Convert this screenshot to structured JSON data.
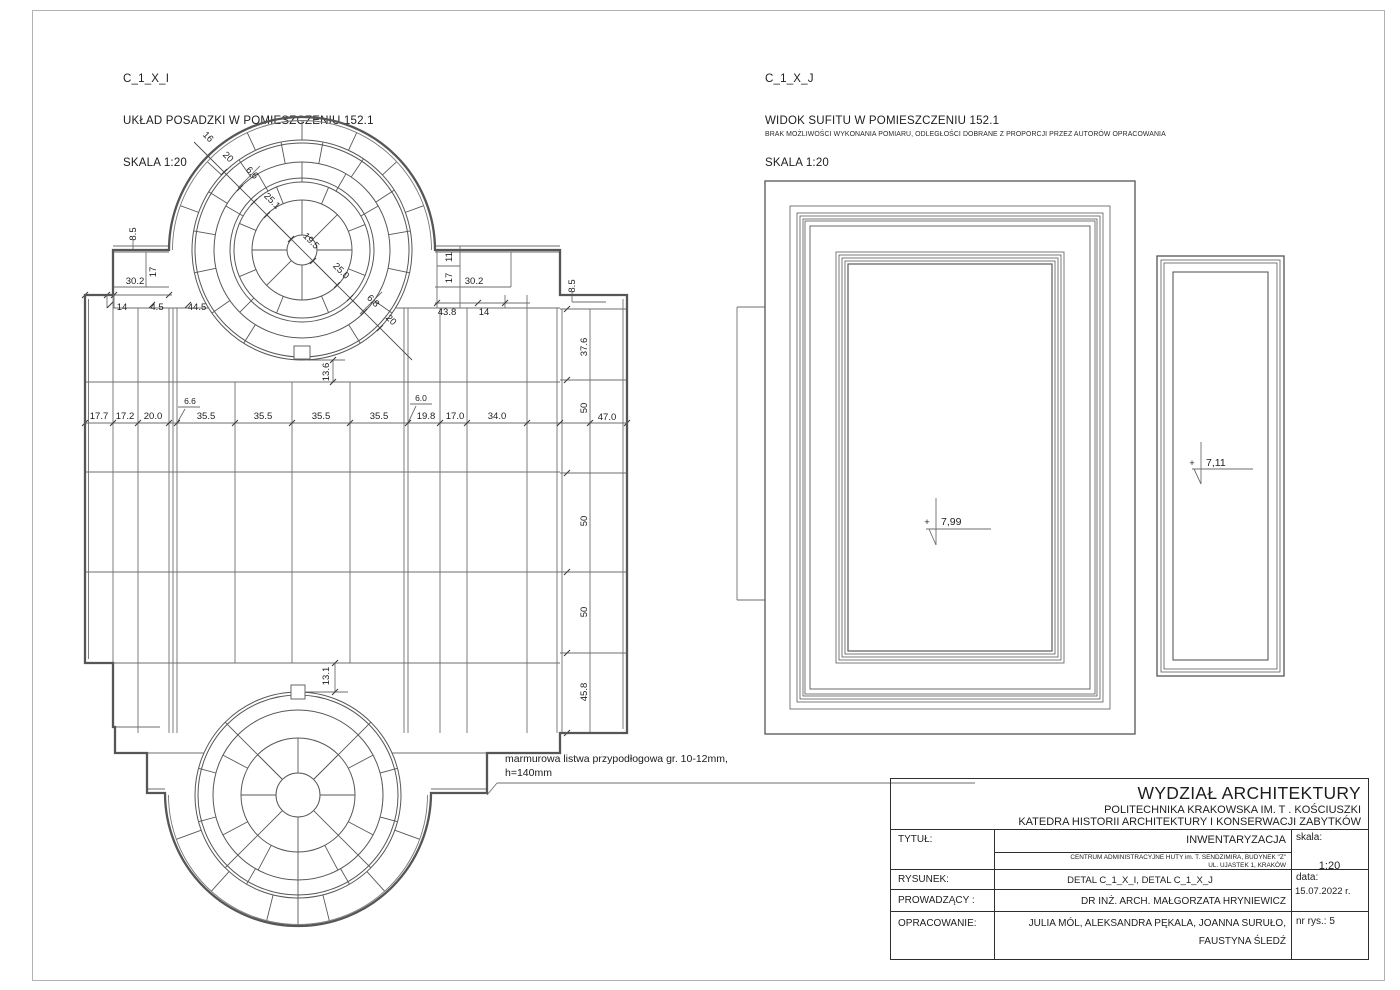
{
  "floor": {
    "heading": {
      "code": "C_1_X_I",
      "title": "UKŁAD POSADZKI W POMIESZCZENIU 152.1",
      "scale": "SKALA 1:20"
    },
    "apse_diag": [
      "16",
      "20",
      "6.6",
      "25.1",
      "19.5",
      "25.0",
      "6.8",
      "20"
    ],
    "top_left": {
      "h85": "8.5",
      "w302": "30.2",
      "w17": "17",
      "b14": "14",
      "b45": "4.5",
      "b445": "44.5"
    },
    "top_right": {
      "w11": "11",
      "w17": "17",
      "w302": "30.2",
      "b438": "43.8",
      "b14": "14",
      "h85": "8.5"
    },
    "columns": [
      "17.7",
      "17.2",
      "20.0",
      "6.6",
      "35.5",
      "35.5",
      "35.5",
      "35.5",
      "6.0",
      "19.8",
      "17.0",
      "34.0",
      "47.0"
    ],
    "rows": [
      "37.6",
      "50",
      "50",
      "50",
      "45.8"
    ],
    "gap_top": "13.6",
    "gap_bottom": "13.1",
    "note1": "marmurowa listwa przypodłogowa gr. 10-12mm,",
    "note2": "h=140mm"
  },
  "ceiling": {
    "heading": {
      "code": "C_1_X_J",
      "title": "WIDOK SUFITU W POMIESZCZENIU 152.1",
      "scale": "SKALA 1:20"
    },
    "note": "BRAK MOŻLIWOŚCI WYKONANIA POMIARU, ODLEGŁOŚCI DOBRANE Z PROPORCJI PRZEZ AUTORÓW OPRACOWANIA",
    "plus": "+",
    "level_main": "7,99",
    "level_side": "7,11"
  },
  "title_block": {
    "faculty": "WYDZIAŁ ARCHITEKTURY",
    "university": "POLITECHNIKA KRAKOWSKA IM. T . KOŚCIUSZKI",
    "department": "KATEDRA HISTORII ARCHITEKTURY I KONSERWACJI ZABYTKÓW",
    "title_label": "TYTUŁ:",
    "title_value": "INWENTARYZACJA",
    "address1": "CENTRUM ADMINISTRACYJNE HUTY im. T. SENDZIMIRA, BUDYNEK \"Z\"",
    "address2": "UL. UJASTEK 1, KRAKÓW",
    "scale_label": "skala:",
    "scale_value": "1:20",
    "drawing_label": "RYSUNEK:",
    "drawing_value": "DETAL C_1_X_I, DETAL C_1_X_J",
    "date_label": "data:",
    "date_value": "15.07.2022 r.",
    "supervisor_label": "PROWADZĄCY :",
    "supervisor_value": "DR INŻ. ARCH. MAŁGORZATA HRYNIEWICZ",
    "authors_label": "OPRACOWANIE:",
    "authors_value1": "JULIA MÓL, ALEKSANDRA PĘKALA, JOANNA SURUŁO,",
    "authors_value2": "FAUSTYNA ŚLEDŹ",
    "number_label": "nr rys.: 5"
  }
}
